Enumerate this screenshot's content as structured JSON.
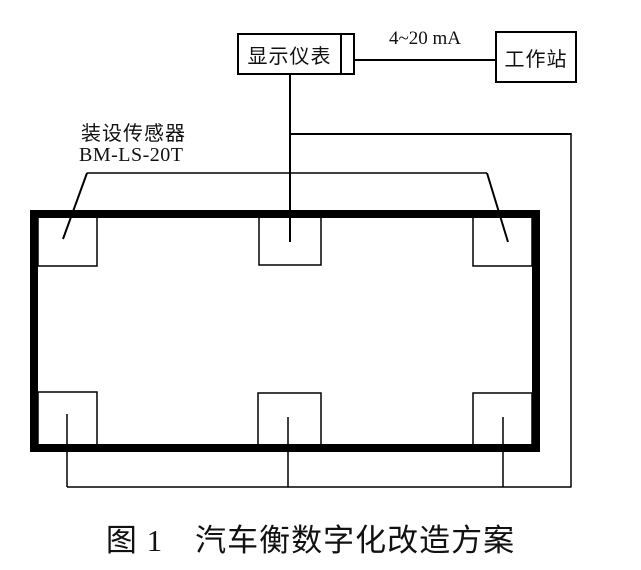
{
  "figure": {
    "nodes": {
      "display_instrument": "显示仪表",
      "workstation": "工作站"
    },
    "wire_label": "4~20 mA",
    "sensor_annotation": {
      "line1": "装设传感器",
      "line2": "BM-LS-20T"
    },
    "caption": "图 1　汽车衡数字化改造方案",
    "sensor_count": 6,
    "colors": {
      "line": "#000000",
      "background": "#ffffff"
    }
  }
}
